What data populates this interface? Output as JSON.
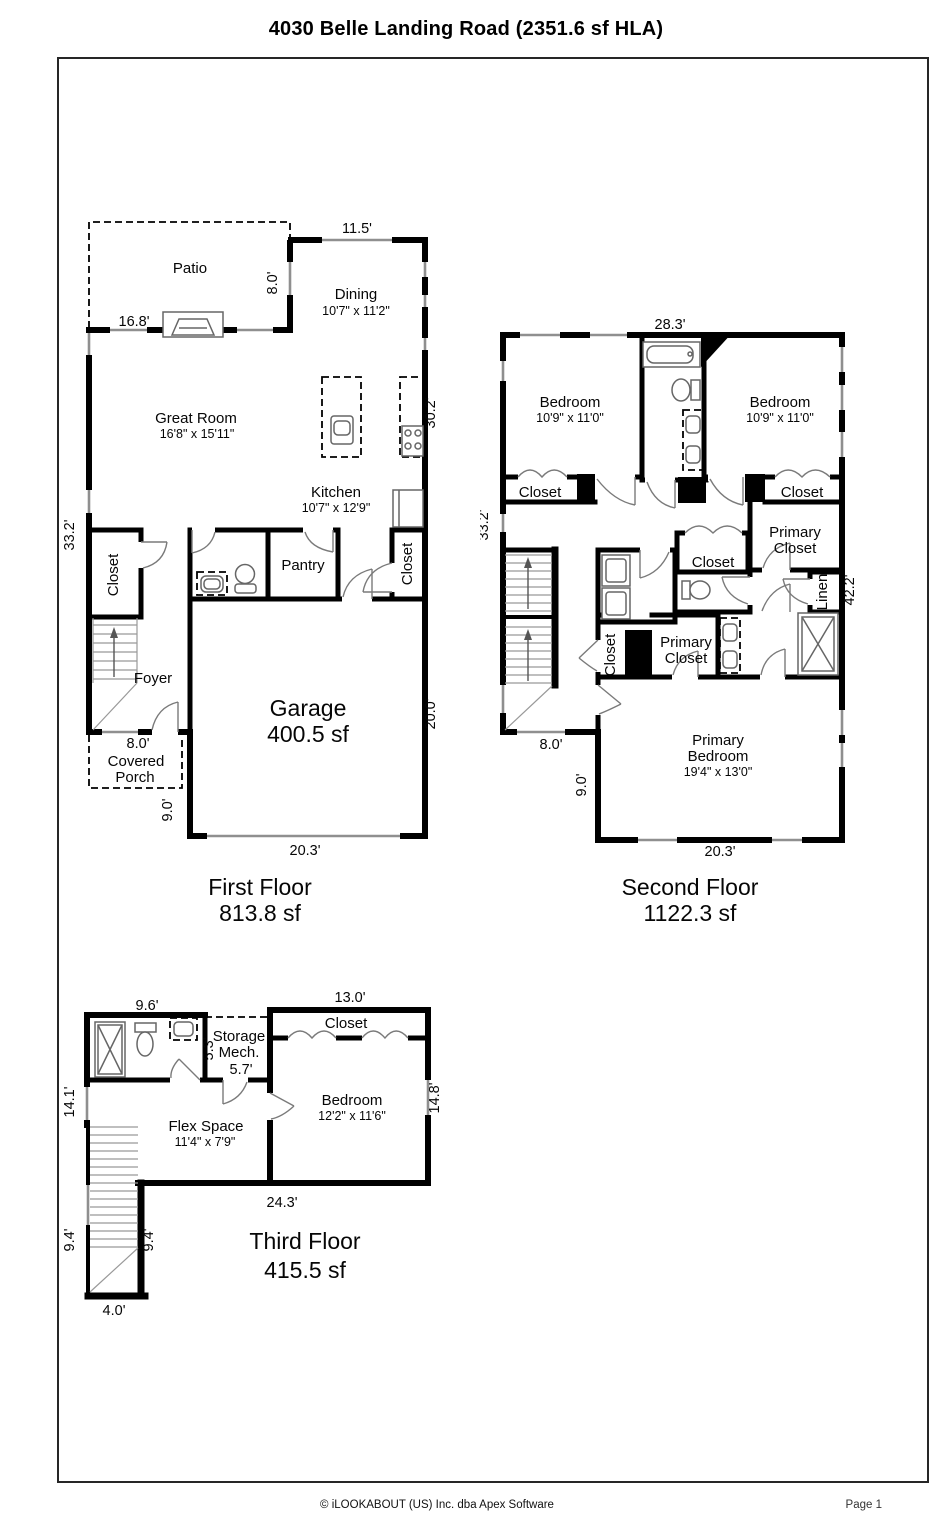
{
  "title": "4030 Belle Landing Road (2351.6 sf HLA)",
  "floors": {
    "first": {
      "title": "First Floor",
      "area": "813.8 sf",
      "rooms": {
        "patio": "Patio",
        "dining": "Dining",
        "dining_size": "10'7\" x 11'2\"",
        "great_room": "Great Room",
        "great_room_size": "16'8\" x 15'11\"",
        "kitchen": "Kitchen",
        "kitchen_size": "10'7\" x 12'9\"",
        "closet_left": "Closet",
        "pantry": "Pantry",
        "closet_right": "Closet",
        "foyer": "Foyer",
        "garage": "Garage",
        "garage_area": "400.5 sf",
        "porch_line1": "Covered",
        "porch_line2": "Porch"
      },
      "dims": {
        "top": "11.5'",
        "patio_depth": "8.0'",
        "patio_width": "16.8'",
        "left": "33.2'",
        "right_upper": "30.2'",
        "right_lower": "20.0'",
        "porch": "8.0'",
        "side": "9.0'",
        "bottom": "20.3'"
      }
    },
    "second": {
      "title": "Second Floor",
      "area": "1122.3 sf",
      "rooms": {
        "bedroom_left": "Bedroom",
        "bedroom_left_size": "10'9\" x 11'0\"",
        "bedroom_right": "Bedroom",
        "bedroom_right_size": "10'9\" x 11'0\"",
        "closet_left": "Closet",
        "closet_right": "Closet",
        "primary_closet_tr_line1": "Primary",
        "primary_closet_tr_line2": "Closet",
        "hall_closet": "Closet",
        "linen": "Linen",
        "closet_small": "Closet",
        "primary_closet_line1": "Primary",
        "primary_closet_line2": "Closet",
        "primary_bedroom_line1": "Primary",
        "primary_bedroom_line2": "Bedroom",
        "primary_bedroom_size": "19'4\" x 13'0\""
      },
      "dims": {
        "top": "28.3'",
        "left": "33.2'",
        "right": "42.2'",
        "left_bottom": "8.0'",
        "side": "9.0'",
        "bottom": "20.3'"
      }
    },
    "third": {
      "title": "Third Floor",
      "area": "415.5 sf",
      "rooms": {
        "storage_line1": "Storage",
        "storage_line2": "Mech.",
        "closet": "Closet",
        "flex_space": "Flex Space",
        "flex_space_size": "11'4\" x 7'9\"",
        "bedroom": "Bedroom",
        "bedroom_size": "12'2\" x 11'6\""
      },
      "dims": {
        "bath_width": "9.6'",
        "closet_width": "13.0'",
        "storage_depth": "5.3'",
        "storage_width": "5.7'",
        "left": "14.1'",
        "right": "14.8'",
        "bottom": "24.3'",
        "stair_left": "9.4'",
        "stair_right": "9.4'",
        "stair_bottom": "4.0'"
      }
    }
  },
  "footer": {
    "copyright": "© iLOOKABOUT (US) Inc. dba Apex Software",
    "page": "Page 1"
  }
}
